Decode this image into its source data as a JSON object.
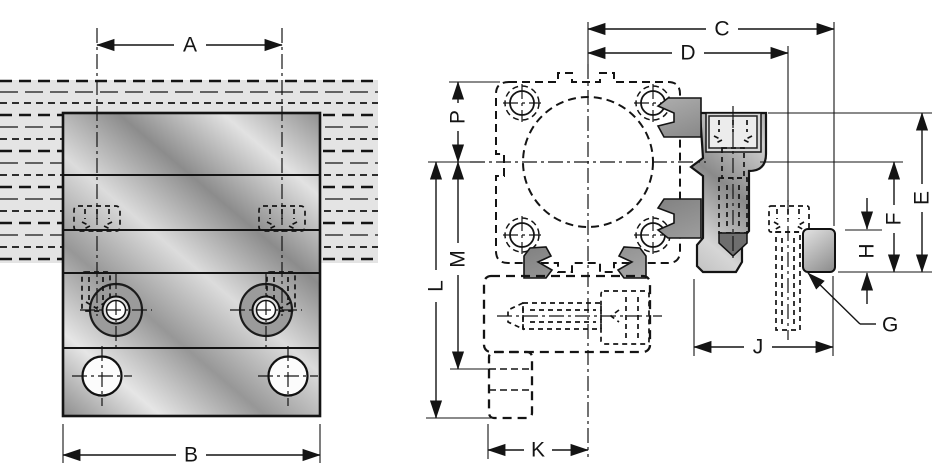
{
  "drawing_labels": {
    "a": "A",
    "b": "B",
    "c": "C",
    "d": "D",
    "e": "E",
    "f": "F",
    "g": "G",
    "h": "H",
    "j": "J",
    "k": "K",
    "l": "L",
    "m": "M",
    "p": "P"
  },
  "colors": {
    "line": "#141414",
    "background": "#ffffff",
    "rail_fill": "#e4e4e4",
    "profile_fill": "#e7e7e7",
    "screw_fill": "#ececec",
    "counterbore_ring": "#9b9b9b",
    "metal_dark": "#8f8f8f",
    "metal_light": "#e7e7e7"
  }
}
